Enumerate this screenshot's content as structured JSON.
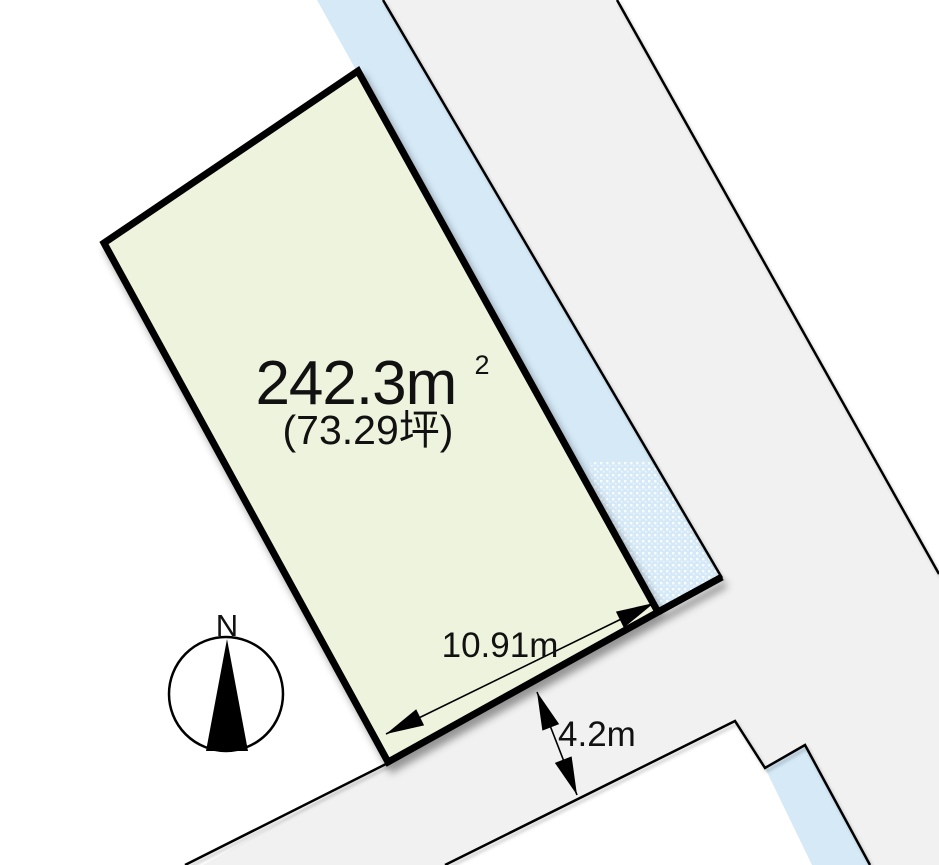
{
  "diagram": {
    "parcel": {
      "area_m2": "242.3m",
      "area_m2_superscript": "2",
      "area_tsubo": "(73.29坪)"
    },
    "dimensions": {
      "frontage": "10.91m",
      "road_width": "4.2m"
    },
    "compass": {
      "north_label": "N"
    },
    "colors": {
      "background": "#ffffff",
      "parcel_fill": "#edf3dc",
      "water_fill": "#d5e9f7",
      "road_fill": "#f1f1f2",
      "line": "#000000"
    }
  }
}
